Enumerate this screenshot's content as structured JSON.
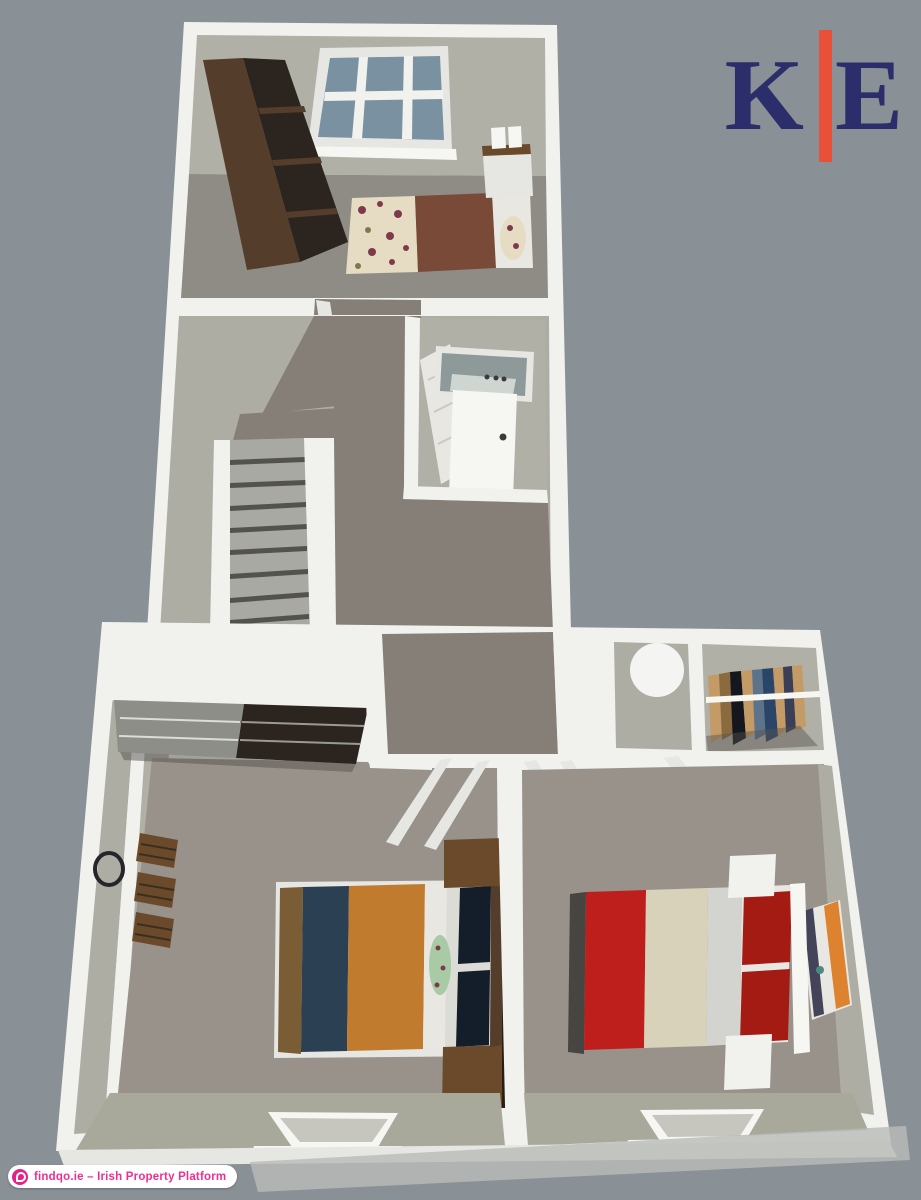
{
  "background": {
    "color": "#8a9196"
  },
  "logo": {
    "letter_left": "K",
    "letter_right": "E",
    "letter_color": "#2b2e6b",
    "bar_color": "#e8503a"
  },
  "badge": {
    "text": "findqo.ie – Irish Property Platform",
    "text_color": "#ee2f92",
    "background": "#ffffff",
    "icon": "findqo-circle-icon",
    "icon_color": "#e42388"
  },
  "floorplan": {
    "view": "3D dollhouse top-down render of an upper storey",
    "features": [
      "top bedroom with six-pane window, dark wardrobe, floral double bed and bedside unit",
      "landing with carpet path and descending staircase",
      "bathroom with framed mirror, white door and bath",
      "central hallway with dark carpet",
      "left bedroom with fitted wardrobe, round wall mirror, wall shelves and navy/orange bed with wood headboard unit",
      "right bedroom with red/cream bed, white headboard and striped wall art",
      "closet area with round lamp and rail of hanging clothes",
      "two white dormer windows in the sloped front wall"
    ]
  },
  "palette": {
    "bg": "#8a9196",
    "wall": "#f1f1ee",
    "wallSoft": "#e6e6e2",
    "wallShade": "#c6c6bf",
    "beigeWall": "#b1b0a7",
    "beigeFloor": "#aeada4",
    "greenBeige": "#a8a89b",
    "carpetRoom": "#98928b",
    "carpetDark": "#857f78",
    "carpetTop": "#8f8c86",
    "stair": "#a9a9a3",
    "stairNose": "#53524d",
    "woodDark": "#543d2b",
    "woodPanel": "#2c241e",
    "woodMid": "#6b4a2c",
    "woodLight": "#7a5c35",
    "woodEdge": "#2a1d12",
    "slatGray": "#8e8e88",
    "slatLine": "#9a9a94",
    "glass": "#7a91a1",
    "mirror": "#8d9a99",
    "mirrorLite": "#cfd6d2",
    "floralBase": "#e6dcc3",
    "floralDot": "#7d3a4a",
    "oliveDot": "#7a7a4a",
    "bedBrown": "#7a4a38",
    "whiteSoft": "#e8e7e2",
    "sheet": "#dcdcd6",
    "navy": "#2c4054",
    "pillowNavy": "#141e2b",
    "orange": "#c17b2f",
    "cushionGreen": "#a8cba6",
    "red": "#bf1f1c",
    "redDark": "#a41b14",
    "cream": "#d9d2ba",
    "silver": "#d3d3cf",
    "shadowEdge": "#474542",
    "artNavy": "#43435a",
    "artOrange": "#dd822f",
    "artTeal": "#4a8a80",
    "clothTan": "#c49a66",
    "clothBrown": "#8a6a3f",
    "clothBlack": "#16161e",
    "clothSteel": "#5d7389",
    "clothNavy": "#2b4569",
    "clothSlate": "#3a3f55",
    "shadow": "#55524c",
    "circleWhite": "#f4f4f2",
    "ring": "#26262a",
    "knob": "#3a3a3a",
    "white": "#f6f6f3",
    "skirt": "#b9bcb8"
  }
}
